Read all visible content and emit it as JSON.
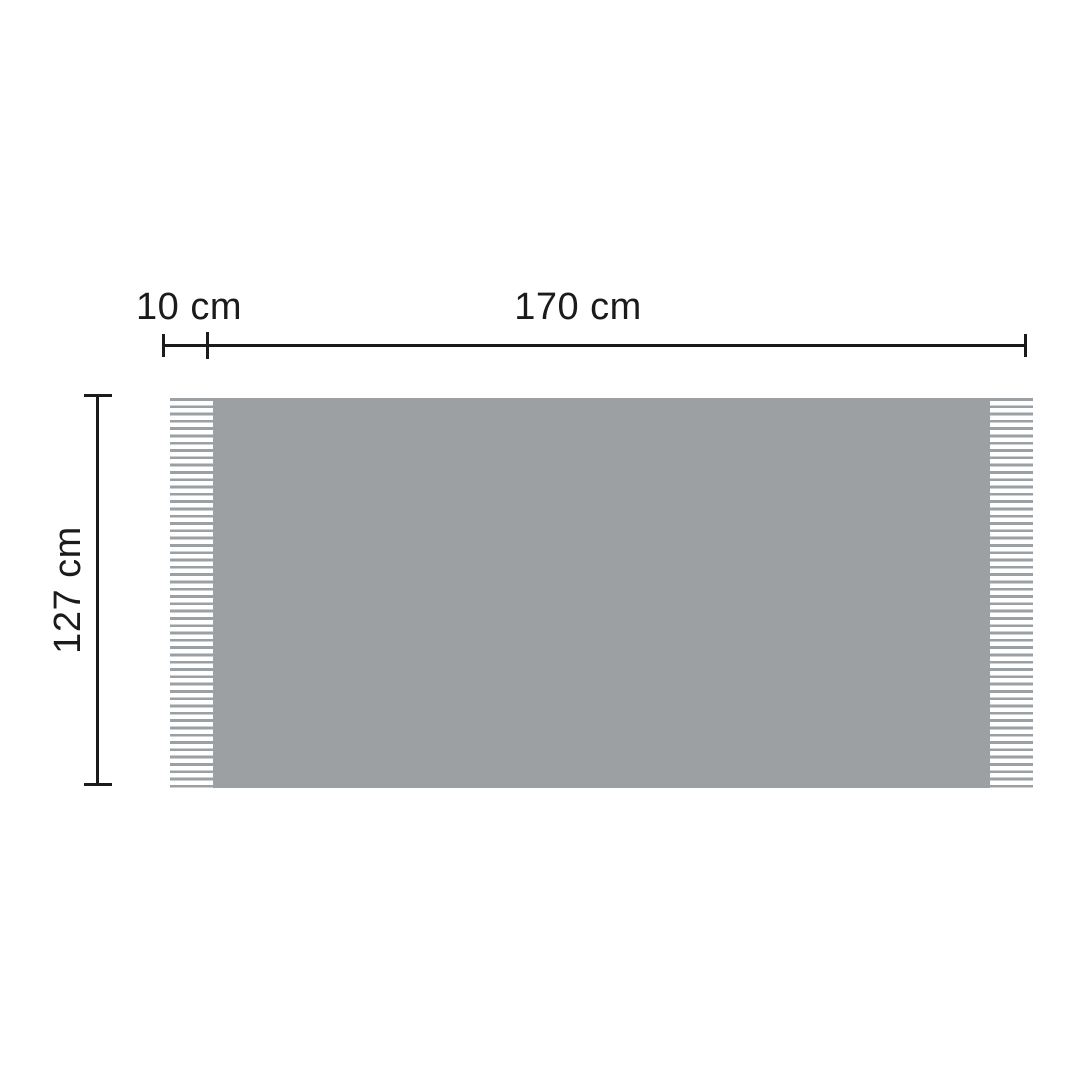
{
  "diagram": {
    "type": "product-dimension-diagram",
    "subject": "blanket-with-fringe",
    "dimensions": {
      "fringe_width_label": "10 cm",
      "width_label": "170 cm",
      "height_label": "127 cm"
    },
    "colors": {
      "blanket": "#9ca0a3",
      "fringe": "#9aa0a3",
      "line": "#1b1b1b",
      "text": "#1b1b1b",
      "background": "#ffffff"
    }
  }
}
